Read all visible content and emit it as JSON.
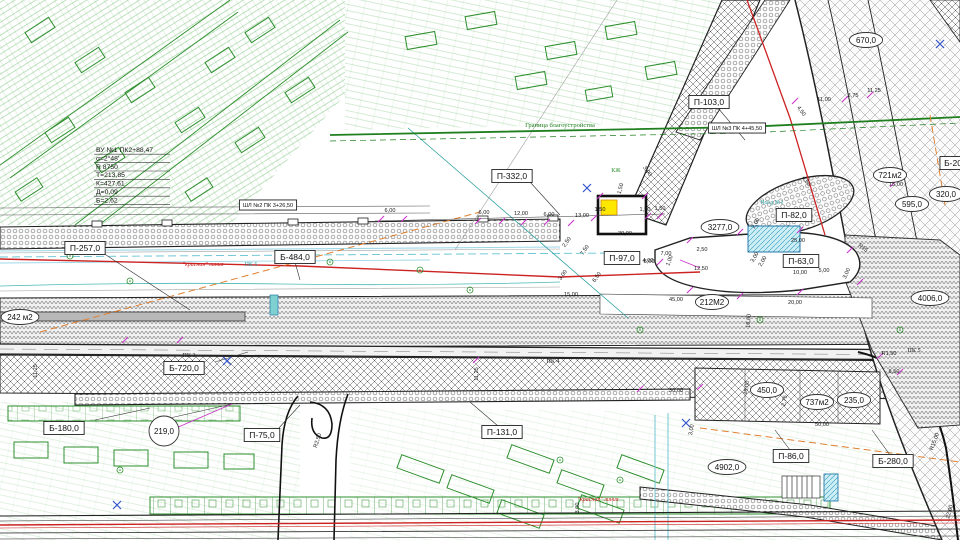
{
  "drawing_title": "План благоустройства улицы (фрагмент генплана)",
  "colors": {
    "cadastral_green": "#2d8f2d",
    "red_line": "#cc2222",
    "utility_cyan": "#63c3cf",
    "utility_lightblue": "#9ed7e8",
    "dimension_magenta": "#cc33cc",
    "orange_dashed": "#e08030",
    "yellow_marker": "#ffe800",
    "teal_text": "#2ca0a0",
    "boundary_green": "#1f7f1f",
    "linework_dark": "#222222",
    "blue_mark": "#3355cc"
  },
  "map": {
    "curve_table": {
      "y": 152,
      "lines": [
        "ВУ №1 ПК2+88,47",
        "α=2°48'",
        "R 8750",
        "Т=213,85",
        "К=427,61",
        "Д=0,09",
        "Б=2,62"
      ]
    },
    "boxed_labels": [
      {
        "id": "p257",
        "text": "П-257,0",
        "x": 85,
        "y": 248
      },
      {
        "id": "b484",
        "text": "Б-484,0",
        "x": 295,
        "y": 257
      },
      {
        "id": "p332",
        "text": "П-332,0",
        "x": 512,
        "y": 176
      },
      {
        "id": "p103",
        "text": "П-103,0",
        "x": 709,
        "y": 102
      },
      {
        "id": "shl3",
        "text": "ШЛ №3 ПК 4+45,50",
        "x": 737,
        "y": 128,
        "fs": 5.6
      },
      {
        "id": "shl2",
        "text": "ШЛ №2 ПК 3+26,50",
        "x": 268,
        "y": 205,
        "fs": 5.6
      },
      {
        "id": "p82",
        "text": "П-82,0",
        "x": 794,
        "y": 215
      },
      {
        "id": "p97",
        "text": "П-97,0",
        "x": 622,
        "y": 258
      },
      {
        "id": "p63",
        "text": "П-63,0",
        "x": 801,
        "y": 261
      },
      {
        "id": "b720",
        "text": "Б-720,0",
        "x": 184,
        "y": 368
      },
      {
        "id": "b180",
        "text": "Б-180,0",
        "x": 64,
        "y": 428
      },
      {
        "id": "p75",
        "text": "П-75,0",
        "x": 262,
        "y": 435
      },
      {
        "id": "p131",
        "text": "П-131,0",
        "x": 502,
        "y": 432
      },
      {
        "id": "p86",
        "text": "П-86,0",
        "x": 791,
        "y": 456
      },
      {
        "id": "b280",
        "text": "Б-280,0",
        "x": 893,
        "y": 461
      },
      {
        "id": "b200",
        "text": "Б-20",
        "x": 953,
        "y": 163
      }
    ],
    "bubble_labels": [
      {
        "id": "a219",
        "text": "219,0",
        "x": 164,
        "y": 431,
        "circle": true
      },
      {
        "id": "a242",
        "text": "242 м2",
        "x": 20,
        "y": 317
      },
      {
        "id": "a212",
        "text": "212М2",
        "x": 712,
        "y": 302
      },
      {
        "id": "a3277",
        "text": "3277,0",
        "x": 720,
        "y": 227
      },
      {
        "id": "a721",
        "text": "721м2",
        "x": 890,
        "y": 175
      },
      {
        "id": "a670",
        "text": "670,0",
        "x": 866,
        "y": 40
      },
      {
        "id": "a595",
        "text": "595,0",
        "x": 912,
        "y": 204
      },
      {
        "id": "a320",
        "text": "320,0",
        "x": 946,
        "y": 194
      },
      {
        "id": "a4006",
        "text": "4006,0",
        "x": 930,
        "y": 298
      },
      {
        "id": "a4902",
        "text": "4902,0",
        "x": 727,
        "y": 467
      },
      {
        "id": "a450",
        "text": "450,0",
        "x": 767,
        "y": 390
      },
      {
        "id": "a737",
        "text": "737м2",
        "x": 817,
        "y": 402
      },
      {
        "id": "a235",
        "text": "235,0",
        "x": 854,
        "y": 400
      }
    ],
    "station_labels": [
      {
        "text": "ПК 3",
        "x": 189,
        "y": 357
      },
      {
        "text": "ПК 4",
        "x": 553,
        "y": 363
      },
      {
        "text": "ПК 5",
        "x": 914,
        "y": 352
      }
    ],
    "text_labels": [
      {
        "text": "\"красная\" линия",
        "x": 203,
        "y": 266,
        "color": "#cc2222",
        "fs": 6,
        "italic": true
      },
      {
        "text": "ПК 5",
        "x": 251,
        "y": 266,
        "color": "#2ca0a0",
        "fs": 6
      },
      {
        "text": "\"красная\" линия",
        "x": 598,
        "y": 501,
        "color": "#cc2222",
        "fs": 6,
        "italic": true
      },
      {
        "text": "Граница благоустройства",
        "x": 560,
        "y": 127,
        "color": "#1f7f1f",
        "fs": 6.5
      },
      {
        "text": "Вход №1",
        "x": 772,
        "y": 204,
        "color": "#2ca0a0",
        "fs": 6
      },
      {
        "text": "КЖ",
        "x": 616,
        "y": 172,
        "color": "#2d8f2d",
        "fs": 6
      }
    ],
    "dim_labels": [
      {
        "text": "6,00",
        "x": 390,
        "y": 212
      },
      {
        "text": "6,00",
        "x": 484,
        "y": 214
      },
      {
        "text": "12,00",
        "x": 521,
        "y": 215
      },
      {
        "text": "6,00",
        "x": 549,
        "y": 216
      },
      {
        "text": "13,00",
        "x": 582,
        "y": 217
      },
      {
        "text": "1,50",
        "x": 600,
        "y": 211
      },
      {
        "text": "1,50",
        "x": 645,
        "y": 211
      },
      {
        "text": "1,50",
        "x": 622,
        "y": 189,
        "r": -75
      },
      {
        "text": "30,00",
        "x": 625,
        "y": 235
      },
      {
        "text": "7,50",
        "x": 586,
        "y": 251,
        "r": -55
      },
      {
        "text": "2,50",
        "x": 568,
        "y": 243,
        "r": -55
      },
      {
        "text": "3,00",
        "x": 564,
        "y": 276,
        "r": -55
      },
      {
        "text": "6,50",
        "x": 598,
        "y": 278,
        "r": -55
      },
      {
        "text": "8,00",
        "x": 649,
        "y": 263
      },
      {
        "text": "1,00",
        "x": 671,
        "y": 261,
        "r": -70
      },
      {
        "text": "12,50",
        "x": 701,
        "y": 270
      },
      {
        "text": "10,00",
        "x": 800,
        "y": 274
      },
      {
        "text": "5,00",
        "x": 824,
        "y": 272
      },
      {
        "text": "25,00",
        "x": 798,
        "y": 242
      },
      {
        "text": "20,00",
        "x": 795,
        "y": 304
      },
      {
        "text": "45,00",
        "x": 676,
        "y": 301
      },
      {
        "text": "15,00",
        "x": 571,
        "y": 296
      },
      {
        "text": "11,00",
        "x": 824,
        "y": 101
      },
      {
        "text": "3,75",
        "x": 853,
        "y": 97
      },
      {
        "text": "11,25",
        "x": 874,
        "y": 92
      },
      {
        "text": "15,00",
        "x": 896,
        "y": 186
      },
      {
        "text": "4,50",
        "x": 800,
        "y": 112,
        "r": 55
      },
      {
        "text": "50,00",
        "x": 822,
        "y": 426
      },
      {
        "text": "30,00",
        "x": 676,
        "y": 392
      },
      {
        "text": "16,00",
        "x": 748,
        "y": 388,
        "r": -80
      },
      {
        "text": "8,50",
        "x": 894,
        "y": 373
      },
      {
        "text": "R1,50",
        "x": 889,
        "y": 355
      },
      {
        "text": "R15,00",
        "x": 936,
        "y": 442,
        "r": -70
      },
      {
        "text": "R2,50",
        "x": 319,
        "y": 441,
        "r": -72
      },
      {
        "text": "11,25",
        "x": 478,
        "y": 374,
        "r": -90
      },
      {
        "text": "11,25",
        "x": 37,
        "y": 371,
        "r": -90
      },
      {
        "text": "3,00",
        "x": 579,
        "y": 508,
        "r": -90
      },
      {
        "text": "R15",
        "x": 862,
        "y": 249,
        "r": 40
      },
      {
        "text": "2,50",
        "x": 702,
        "y": 251
      },
      {
        "text": "7,00",
        "x": 666,
        "y": 255
      },
      {
        "text": "4,00",
        "x": 648,
        "y": 262
      },
      {
        "text": "3,00",
        "x": 756,
        "y": 258,
        "r": -60
      },
      {
        "text": "2,00",
        "x": 764,
        "y": 262,
        "r": -60
      },
      {
        "text": "3,00",
        "x": 848,
        "y": 274,
        "r": -65
      },
      {
        "text": "16,00",
        "x": 750,
        "y": 321,
        "r": -85
      },
      {
        "text": "4,50",
        "x": 805,
        "y": 182,
        "r": 55
      },
      {
        "text": "2,00",
        "x": 757,
        "y": 224,
        "r": -60
      },
      {
        "text": "3,00",
        "x": 693,
        "y": 430,
        "r": -80
      },
      {
        "text": "2,75",
        "x": 786,
        "y": 401,
        "r": -80
      },
      {
        "text": "1,50",
        "x": 660,
        "y": 210
      },
      {
        "text": "3,00",
        "x": 646,
        "y": 172,
        "r": 55
      },
      {
        "text": "22,00",
        "x": 951,
        "y": 512,
        "r": -75
      }
    ]
  }
}
